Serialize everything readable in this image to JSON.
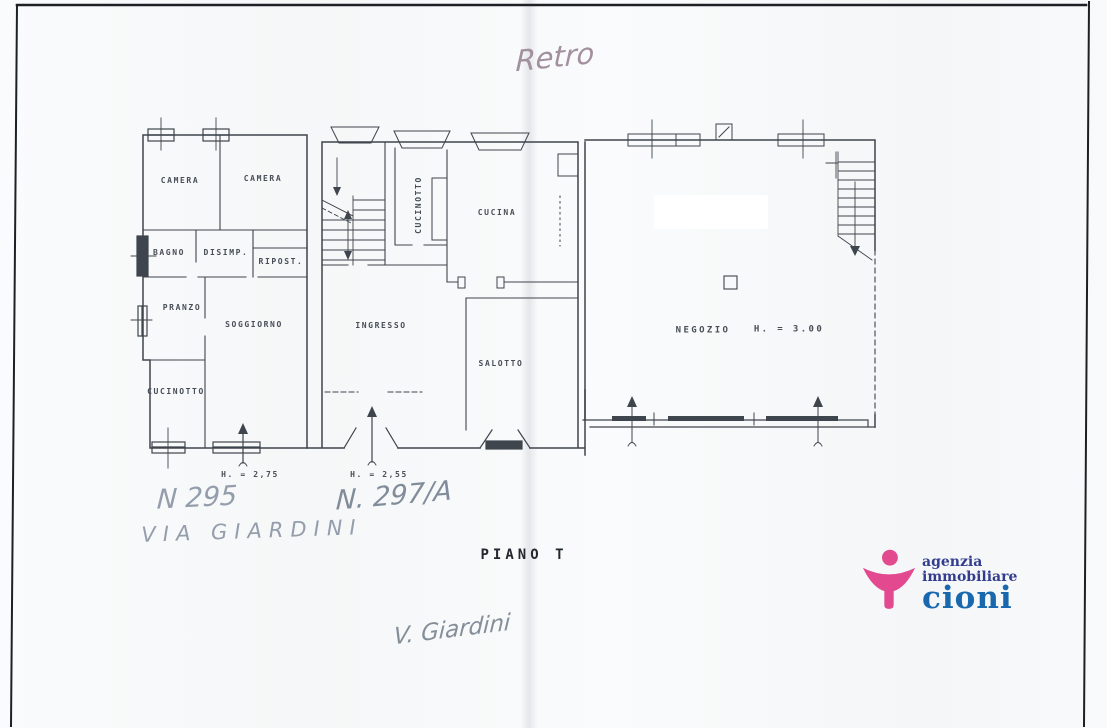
{
  "document": {
    "handwriting": {
      "top_note": "Retro",
      "street_number_left": "N 295",
      "street_name_left": "VIA GIARDINI",
      "street_number_right": "N. 297/A",
      "bottom_note": "V. Giardini"
    },
    "plan": {
      "title": "PIANO T",
      "rooms": {
        "camera_1": "CAMERA",
        "camera_2": "CAMERA",
        "bagno": "BAGNO",
        "disimpegno": "DISIMP.",
        "ripostiglio": "RIPOST.",
        "pranzo": "PRANZO",
        "soggiorno": "SOGGIORNO",
        "cucinotto_left": "CUCINOTTO",
        "cucinotto_center": "CUCINOTTO",
        "cucina": "CUCINA",
        "ingresso": "INGRESSO",
        "salotto": "SALOTTO",
        "negozio": "NEGOZIO"
      },
      "heights": {
        "apartment_left": "H. = 2,75",
        "apartment_center": "H. = 2,55",
        "negozio": "H. = 3.00"
      }
    },
    "logo": {
      "line1": "agenzia",
      "line2": "immobiliare",
      "line3": "cioni",
      "pink": "#e2498f",
      "blue_dark": "#333c8e",
      "blue": "#1968ae"
    },
    "colors": {
      "ink": "#3f454d",
      "scan_border": "#1d2126",
      "handwriting_pink": "#a2909e",
      "handwriting_gray": "#939dab"
    }
  }
}
